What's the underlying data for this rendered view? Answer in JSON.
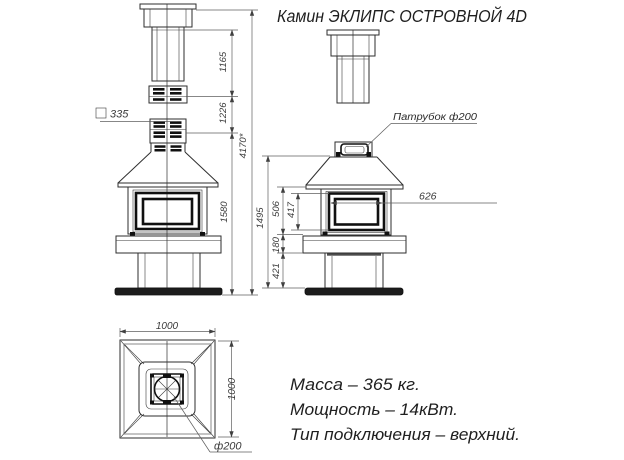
{
  "title": "Камин ЭКЛИПС ОСТРОВНОЙ 4D",
  "front_view": {
    "dim_chimney_pipe": "1165",
    "dim_flue_modules": "1226",
    "dim_total_height": "4170*",
    "dim_body_height": "1580",
    "dim_flue_square": "335"
  },
  "side_view": {
    "label_pipe_socket": "Патрубок ф200",
    "dim_glass_width": "626",
    "dim_view_height": "1495",
    "dim_hood_to_shelf": "506",
    "dim_glass_height": "417",
    "dim_shelf_height": "180",
    "dim_pedestal_height": "421"
  },
  "top_view": {
    "dim_width": "1000",
    "dim_depth": "1000",
    "label_pipe_diameter": "ф200"
  },
  "specs": {
    "mass": "Масса – 365 кг.",
    "power": "Мощность – 14кВт.",
    "connection": "Тип подключения – верхний."
  }
}
